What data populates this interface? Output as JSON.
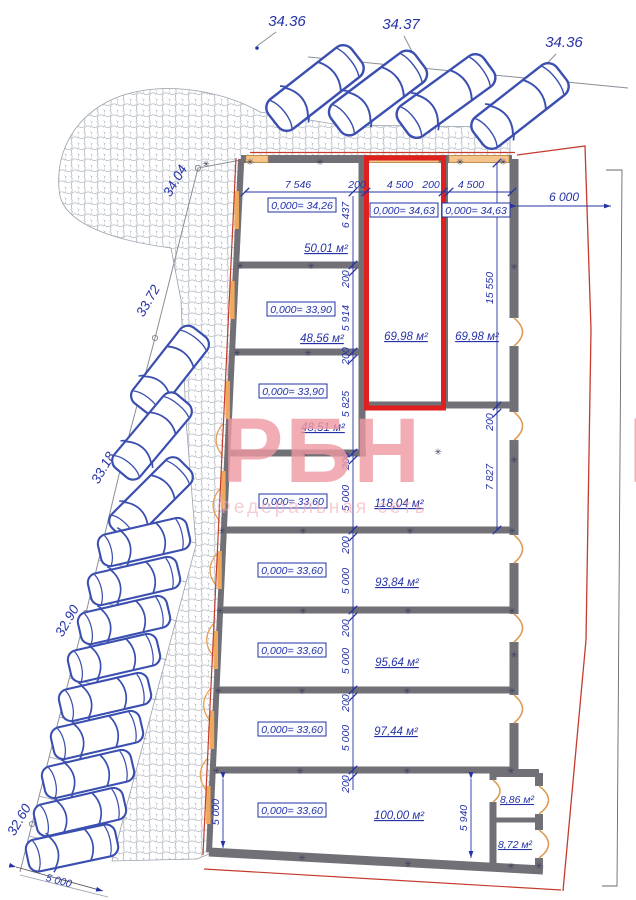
{
  "plan": {
    "elevations_top": [
      "34.36",
      "34.37",
      "34.36"
    ],
    "elevations_left": [
      "34.04",
      "33.72",
      "33.18",
      "32.90",
      "32.60"
    ],
    "dims_top": [
      "7 546",
      "200",
      "4 500",
      "200",
      "4 500"
    ],
    "dim_offset_right": "6 000",
    "dims_left_chain": [
      "6 437",
      "200",
      "5 914",
      "200",
      "5 825",
      "200",
      "5 000",
      "200",
      "5 000",
      "200",
      "5 000",
      "200",
      "5 000",
      "200"
    ],
    "dims_right_chain": [
      "15 550",
      "200",
      "7 827"
    ],
    "dim_annex": "5 940",
    "dim_unit_left": "5 000",
    "dim_parking": "5 000",
    "units": [
      {
        "level": "0,000= 34,26",
        "area": "50,01 м²"
      },
      {
        "level": "0,000= 34,63",
        "area": "69,98 м²",
        "highlighted": true
      },
      {
        "level": "0,000= 34,63",
        "area": "69,98 м²"
      },
      {
        "level": "0,000= 33,90",
        "area": "48,56 м²"
      },
      {
        "level": "0,000= 33,90",
        "area": "48,51 м²"
      },
      {
        "level": "0,000= 33,60",
        "area": "118,04 м²"
      },
      {
        "level": "0,000= 33,60",
        "area": "93,84 м²"
      },
      {
        "level": "0,000= 33,60",
        "area": "95,64 м²"
      },
      {
        "level": "0,000= 33,60",
        "area": "97,44 м²"
      },
      {
        "level": "0,000= 33,60",
        "area": "100,00 м²"
      },
      {
        "area": "8,86 м²"
      },
      {
        "area": "8,72 м²"
      }
    ],
    "watermark": {
      "main": "РБН",
      "sub": "Федеральная сеть",
      "edge": "Р"
    },
    "glyphs": {
      "junction": "✳"
    },
    "colors": {
      "highlight_red": "#e01f1f",
      "dim_blue": "#2633a6",
      "wall_gray": "#707076",
      "boundary_red": "#c53b2e",
      "door_tan": "#dd9c55",
      "watermark_pink": "#f099a2"
    }
  }
}
